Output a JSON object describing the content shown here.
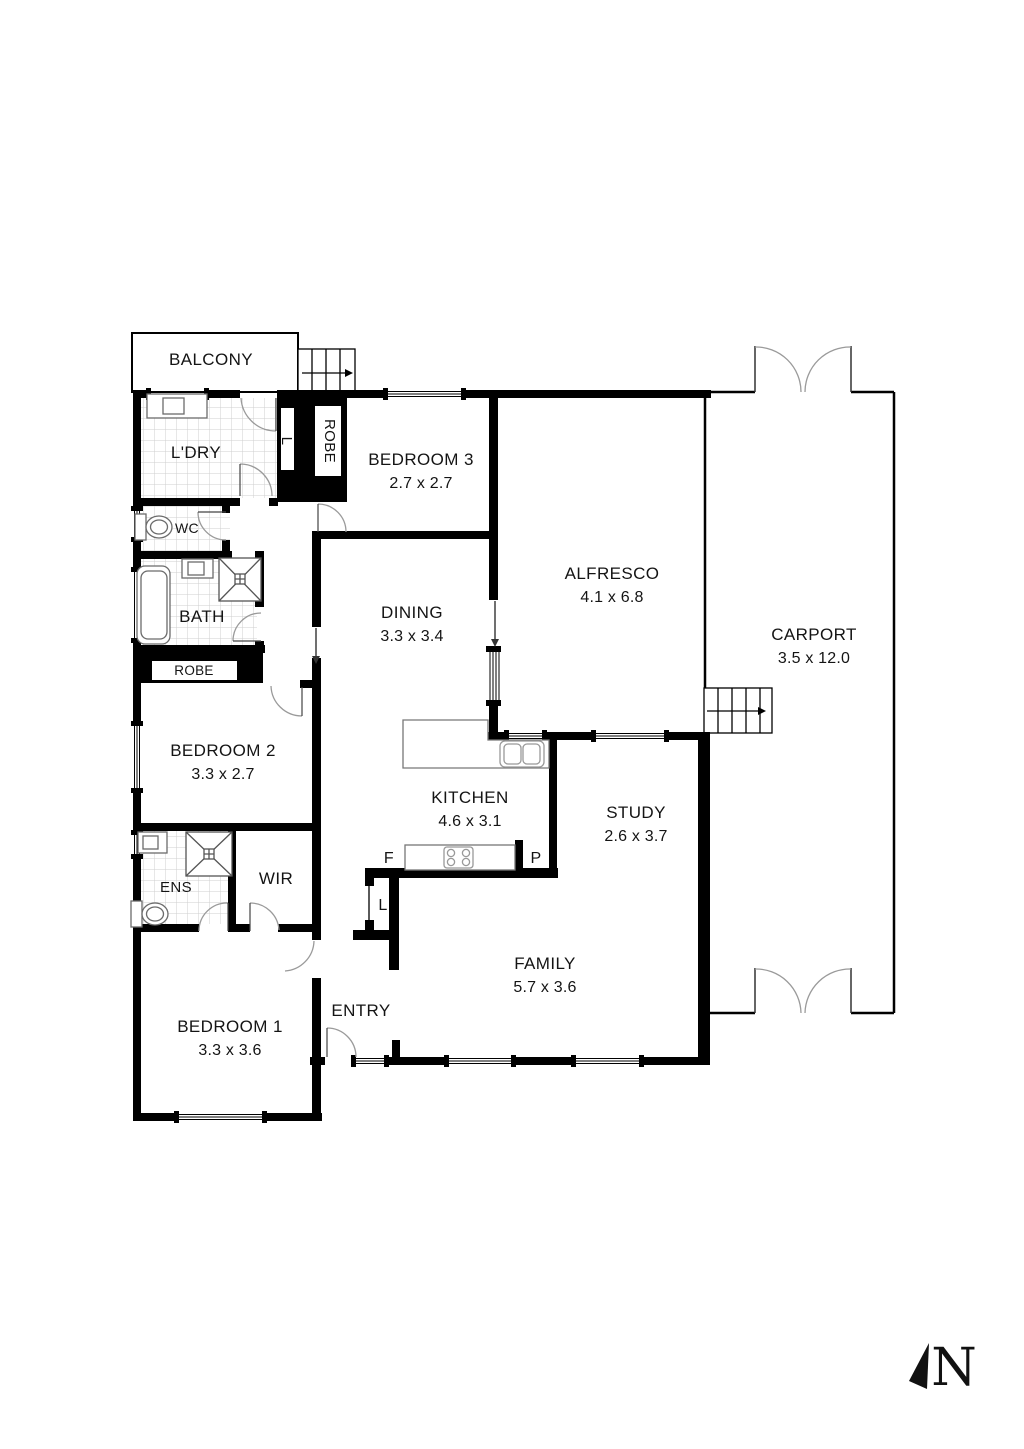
{
  "rooms": {
    "balcony": {
      "label": "BALCONY"
    },
    "laundry": {
      "label": "L'DRY"
    },
    "wc": {
      "label": "WC"
    },
    "bath": {
      "label": "BATH"
    },
    "bedroom2": {
      "label": "BEDROOM 2",
      "dims": "3.3 x 2.7"
    },
    "ens": {
      "label": "ENS"
    },
    "wir": {
      "label": "WIR"
    },
    "bedroom1": {
      "label": "BEDROOM 1",
      "dims": "3.3 x 3.6"
    },
    "entry": {
      "label": "ENTRY"
    },
    "bedroom3": {
      "label": "BEDROOM 3",
      "dims": "2.7 x 2.7"
    },
    "dining": {
      "label": "DINING",
      "dims": "3.3 x 3.4"
    },
    "kitchen": {
      "label": "KITCHEN",
      "dims": "4.6 x 3.1"
    },
    "study": {
      "label": "STUDY",
      "dims": "2.6 x 3.7"
    },
    "family": {
      "label": "FAMILY",
      "dims": "5.7 x 3.6"
    },
    "alfresco": {
      "label": "ALFRESCO",
      "dims": "4.1 x 6.8"
    },
    "carport": {
      "label": "CARPORT",
      "dims": "3.5 x 12.0"
    }
  },
  "closets": {
    "robe_bed3": {
      "label": "ROBE"
    },
    "robe_bed2": {
      "label": "ROBE"
    },
    "linen_upper": {
      "label": "L"
    },
    "linen_hall": {
      "label": "L"
    },
    "fridge": {
      "label": "F"
    },
    "pantry": {
      "label": "P"
    }
  },
  "compass": {
    "label": "N"
  },
  "colors": {
    "wall": "#000000",
    "door_arc": "#9a9a9a",
    "fixture": "#6b6b6b",
    "tile_grid": "#cfcfcf"
  }
}
